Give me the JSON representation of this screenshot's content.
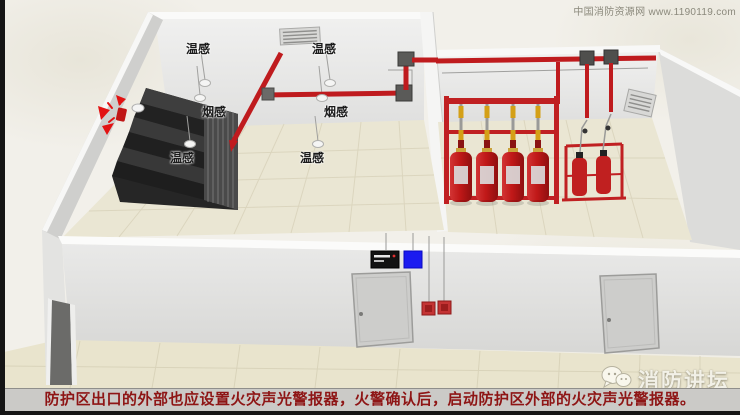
{
  "watermarks": {
    "site": "中国消防资源网 www.1190119.com",
    "brand": "消防讲坛"
  },
  "scene": {
    "sensors": [
      {
        "label": "温感"
      },
      {
        "label": "温感"
      },
      {
        "label": "烟感"
      },
      {
        "label": "烟感"
      },
      {
        "label": "温感"
      },
      {
        "label": "温感"
      }
    ],
    "icons": {
      "exterior_alarm": "sound-light-alarm-icon",
      "brand_logo": "wechat-bubbles-icon",
      "ceiling_vent": "air-vent-icon",
      "wall_vent": "air-vent-icon"
    }
  },
  "caption": {
    "text": "防护区出口的外部也应设置火灾声光警报器，火警确认后，启动防护区外部的火灾声光警报器。"
  },
  "colors": {
    "pipe_red": "#bf1b1e",
    "cylinder_red": "#c02020",
    "alarm_red": "#e21212",
    "indicator_blue": "#1b1bf0",
    "caption_text": "#8e1515",
    "caption_bar": "#cbcac7",
    "floor_beige": "#eae6d3",
    "wall_gray": "#e6e6e6"
  }
}
